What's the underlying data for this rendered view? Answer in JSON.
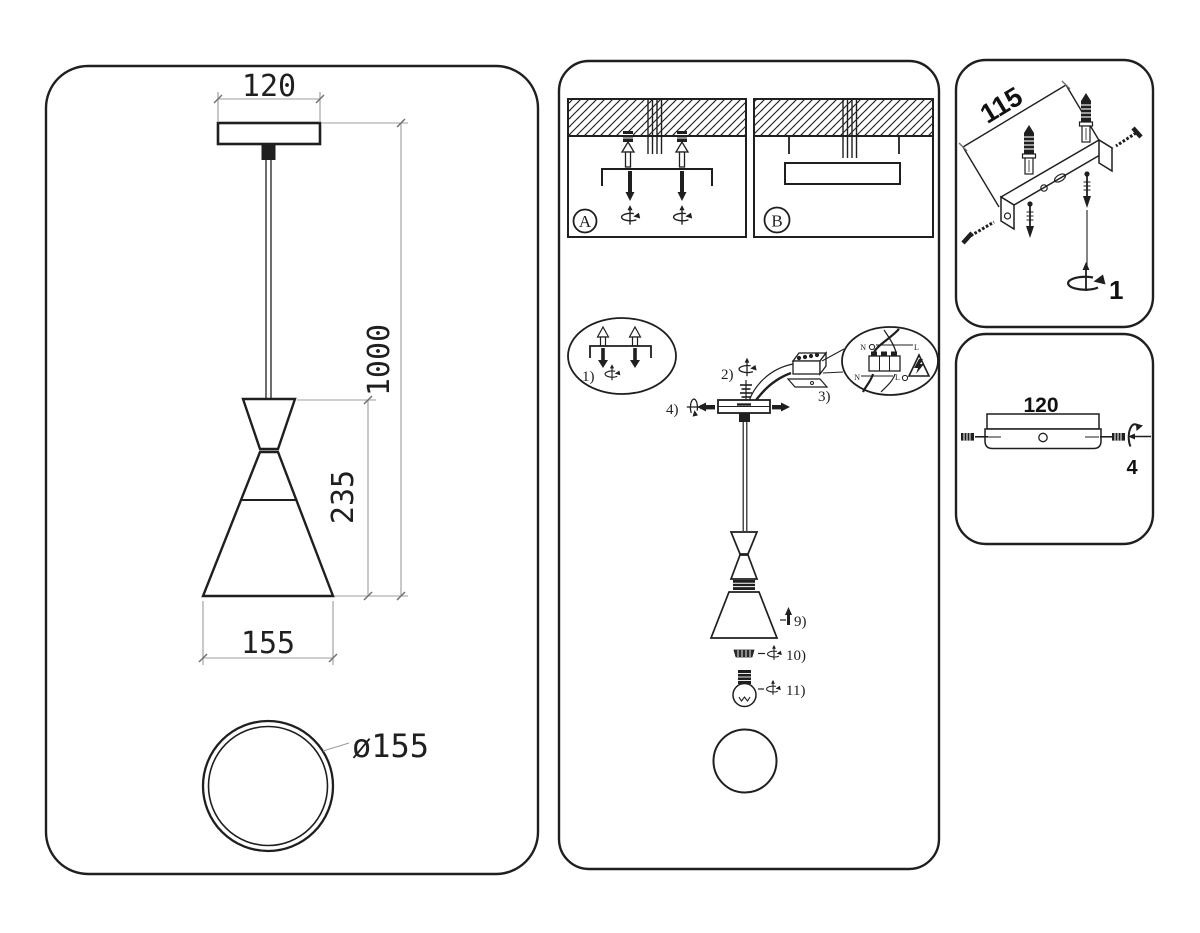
{
  "colors": {
    "line": "#1f1f1f",
    "dim_line": "#9c9c9c",
    "background": "#ffffff"
  },
  "panels": {
    "left": {
      "dim_canopy_width": "120",
      "dim_cord_length": "1000",
      "dim_shade_height": "235",
      "dim_shade_width": "155",
      "dim_shade_diameter": "ø155"
    },
    "middle": {
      "label_a": "A",
      "label_b": "B",
      "step1": "1)",
      "step2": "2)",
      "step3": "3)",
      "step4": "4)",
      "step9": "9)",
      "step10": "10)",
      "step11": "11)",
      "wire_n_top": "N",
      "wire_l_top": "L",
      "wire_n_bottom": "N",
      "wire_l_bottom": "L"
    },
    "top_right": {
      "dim_bracket_length": "115",
      "step": "1"
    },
    "bottom_right": {
      "dim_canopy_width": "120",
      "step": "4"
    }
  }
}
